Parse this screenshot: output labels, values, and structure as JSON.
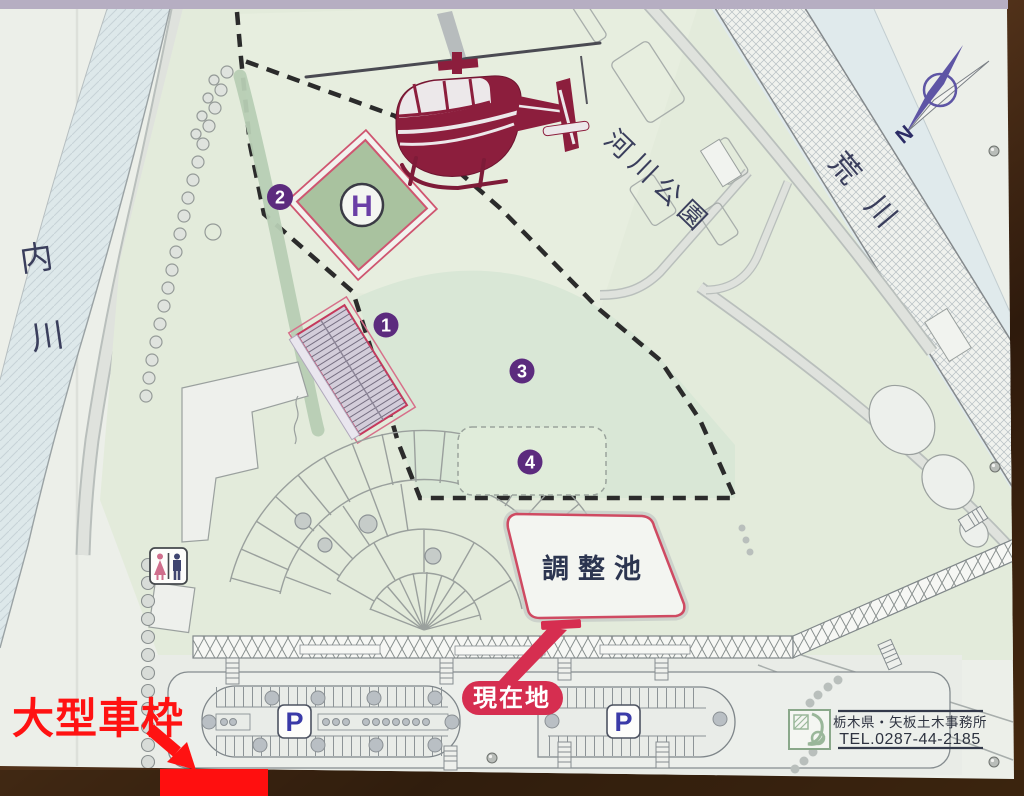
{
  "sign": {
    "park_label": "河川公園",
    "river_left": "内川",
    "river_right": "荒川",
    "compass_north": "N",
    "helipad_letter": "H",
    "zone_markers": [
      {
        "label": "1"
      },
      {
        "label": "2"
      },
      {
        "label": "3"
      },
      {
        "label": "4"
      }
    ],
    "pond_label": "調整池",
    "current_location": "現在地",
    "parking_letter": "P",
    "office": {
      "name": "栃木県・矢板土木事務所",
      "tel": "TEL.0287-44-2185"
    },
    "annotation": {
      "label": "大型車枠"
    },
    "colors": {
      "current_location_red": "#d62e50",
      "annotation_red": "#ff1212",
      "marker_purple": "#5c2b7e",
      "helicopter_maroon": "#8c1e3d",
      "compass_purple": "#5e55a5",
      "helipad_green": "#a9c29f",
      "pond_border_red": "#cf4a62",
      "board_background": "#ecefe9"
    }
  }
}
